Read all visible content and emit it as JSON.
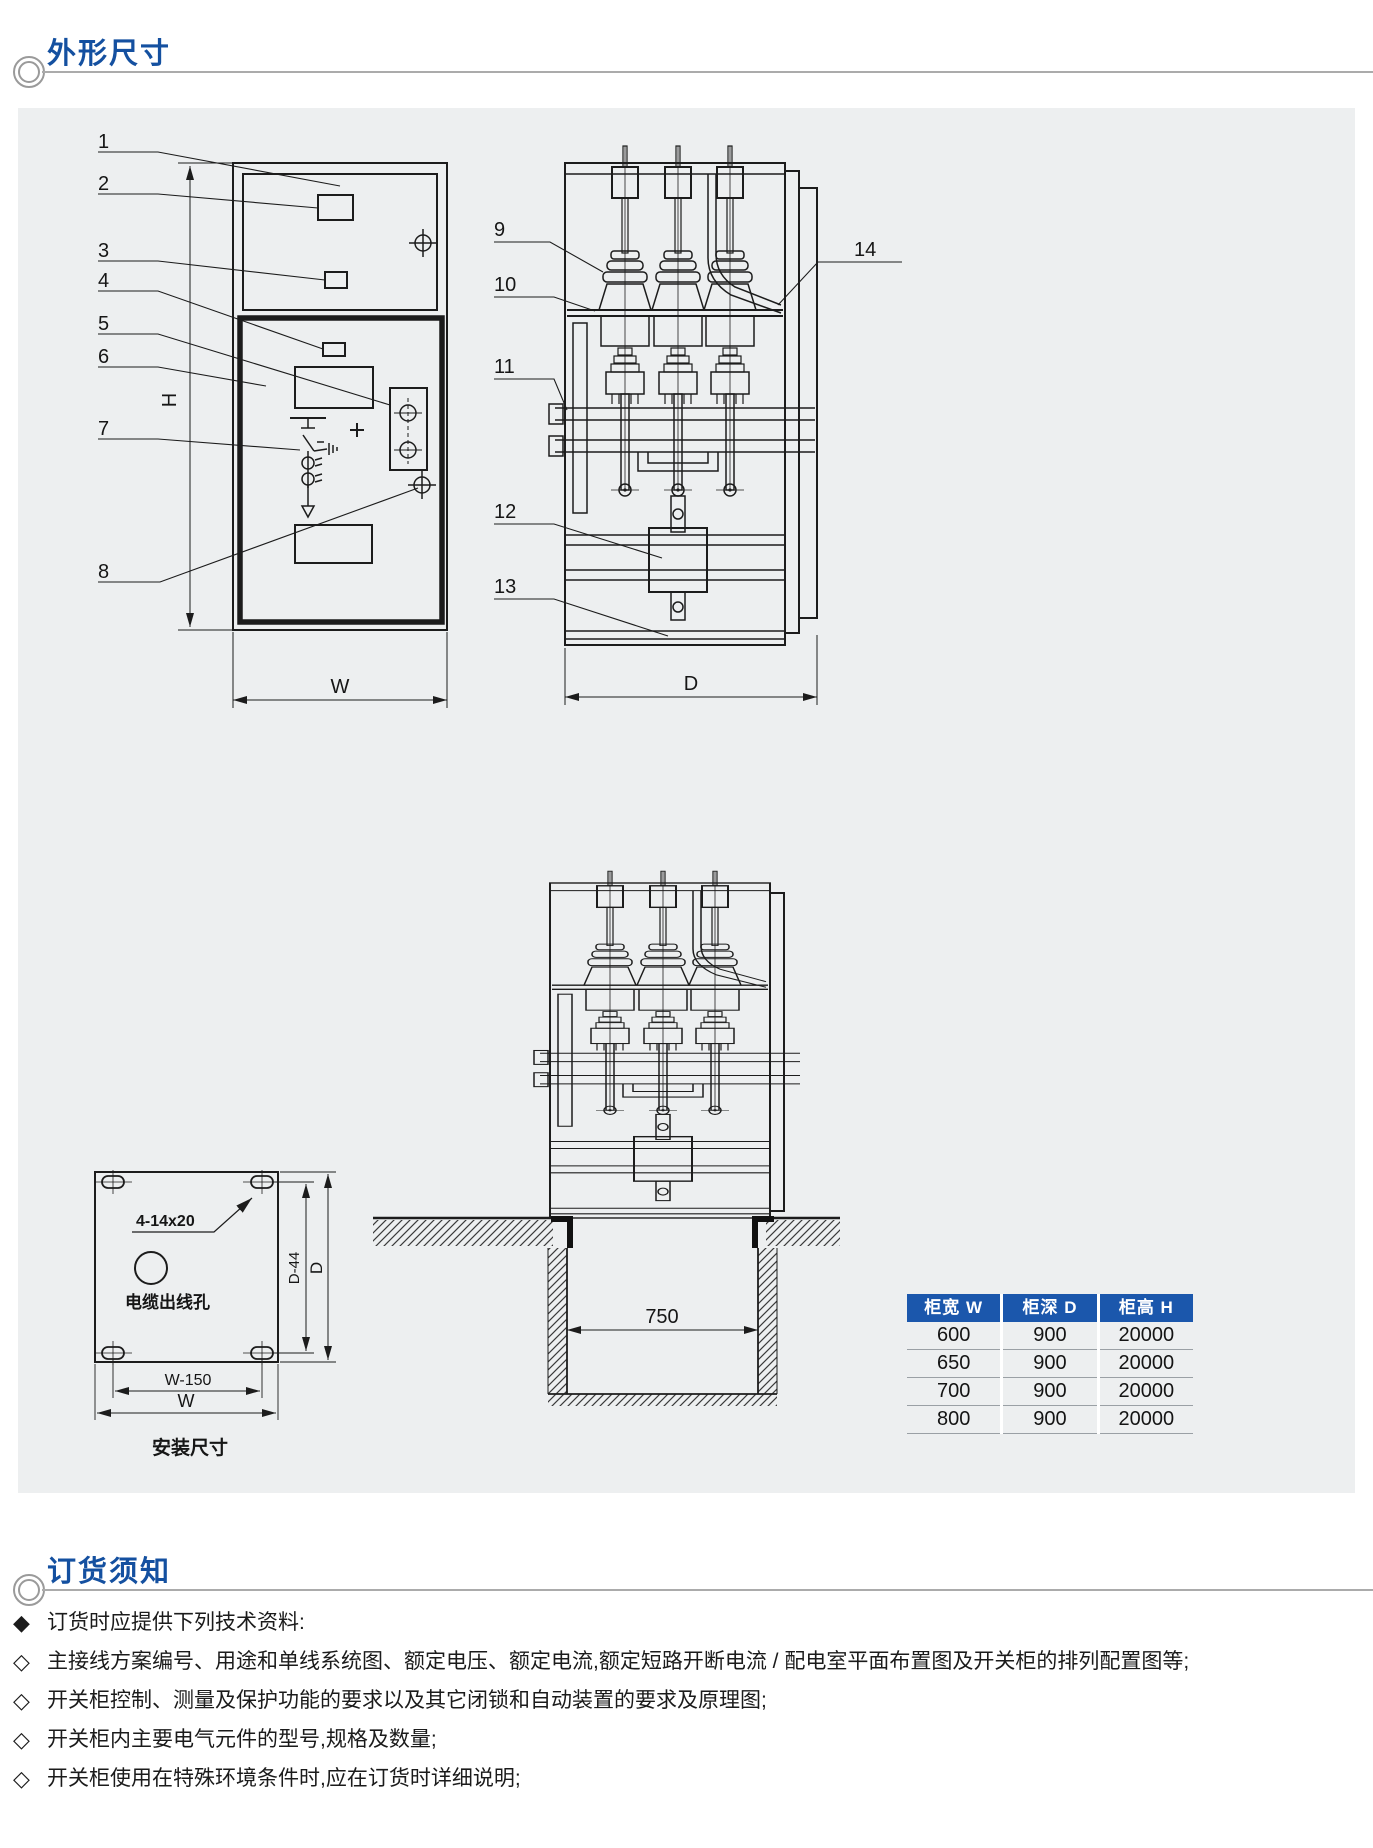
{
  "sections": {
    "outline": {
      "title": "外形尺寸"
    },
    "ordering": {
      "title": "订货须知"
    }
  },
  "front_view": {
    "callouts": [
      "1",
      "2",
      "3",
      "4",
      "5",
      "6",
      "7",
      "8"
    ],
    "height_label": "H",
    "width_label": "W"
  },
  "side_view": {
    "callouts": [
      "9",
      "10",
      "11",
      "12",
      "13",
      "14"
    ],
    "depth_label": "D"
  },
  "foundation_view": {
    "pit_width": "750"
  },
  "installation_view": {
    "hole_spec": "4-14x20",
    "cable_hole_label": "电缆出线孔",
    "width_inner_label": "W-150",
    "width_label": "W",
    "depth_inner_label": "D-44",
    "depth_label": "D",
    "caption": "安装尺寸"
  },
  "dimension_table": {
    "headers": [
      "柜宽 W",
      "柜深 D",
      "柜高 H"
    ],
    "rows": [
      [
        "600",
        "900",
        "20000"
      ],
      [
        "650",
        "900",
        "20000"
      ],
      [
        "700",
        "900",
        "20000"
      ],
      [
        "800",
        "900",
        "20000"
      ]
    ]
  },
  "ordering_notes": {
    "lead_marker": "◆",
    "lead_text": "订货时应提供下列技术资料:",
    "item_marker": "◇",
    "items": [
      "主接线方案编号、用途和单线系统图、额定电压、额定电流,额定短路开断电流 / 配电室平面布置图及开关柜的排列配置图等;",
      "开关柜控制、测量及保护功能的要求以及其它闭锁和自动装置的要求及原理图;",
      "开关柜内主要电气元件的型号,规格及数量;",
      "开关柜使用在特殊环境条件时,应在订货时详细说明;"
    ]
  },
  "colors": {
    "accent_blue": "#1450a0",
    "table_header_bg": "#1b57ac",
    "panel_bg": "#edeff0",
    "line_color": "#1c1c1c"
  }
}
